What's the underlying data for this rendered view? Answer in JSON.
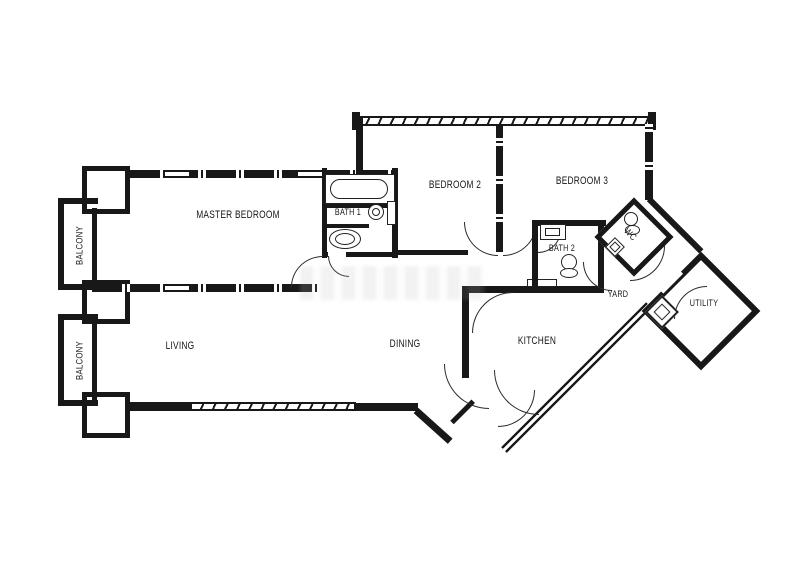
{
  "drawing": {
    "type": "apartment-floor-plan",
    "line_color": "#1a1a1a",
    "background_color": "#ffffff"
  },
  "rooms": {
    "master_bedroom": {
      "label": "MASTER BEDROOM"
    },
    "bath_1": {
      "label": "BATH 1"
    },
    "bedroom_2": {
      "label": "BEDROOM 2"
    },
    "bedroom_3": {
      "label": "BEDROOM 3"
    },
    "balcony_upper": {
      "label": "BALCONY"
    },
    "balcony_lower": {
      "label": "BALCONY"
    },
    "living": {
      "label": "LIVING"
    },
    "dining": {
      "label": "DINING"
    },
    "kitchen": {
      "label": "KITCHEN"
    },
    "bath_2": {
      "label": "BATH 2"
    },
    "wc": {
      "label": "WC"
    },
    "yard": {
      "label": "YARD"
    },
    "utility": {
      "label": "UTILITY"
    }
  },
  "fixtures": [
    {
      "name": "bathtub",
      "room": "bath_1"
    },
    {
      "name": "wash-basin",
      "room": "bath_1"
    },
    {
      "name": "toilet",
      "room": "bath_1"
    },
    {
      "name": "wash-basin",
      "room": "bath_2"
    },
    {
      "name": "toilet",
      "room": "bath_2"
    },
    {
      "name": "toilet",
      "room": "wc"
    },
    {
      "name": "wash-basin",
      "room": "wc"
    },
    {
      "name": "washing-machine",
      "room": "yard"
    },
    {
      "name": "counter",
      "room": "kitchen"
    }
  ]
}
